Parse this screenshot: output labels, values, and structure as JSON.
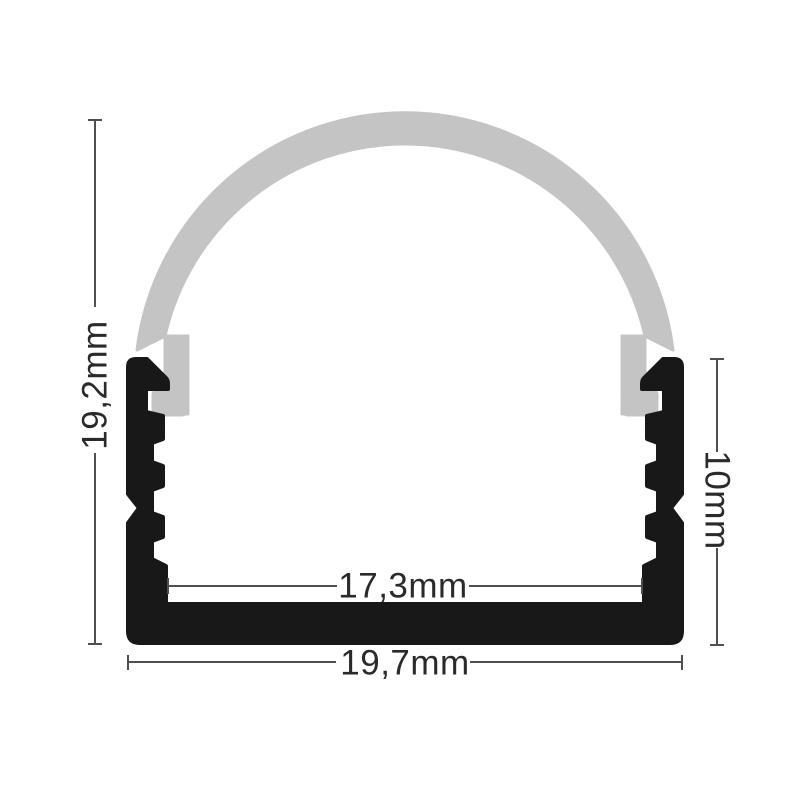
{
  "dimensions": {
    "total_height": "19,2mm",
    "body_height": "10mm",
    "inner_width": "17,3mm",
    "total_width": "19,7mm"
  },
  "colors": {
    "profile_body": "#181818",
    "diffuser_dome": "#c4c4c4",
    "dimension_lines": "#4f4f4f",
    "label_text": "#2a2a2a",
    "background": "#ffffff"
  }
}
